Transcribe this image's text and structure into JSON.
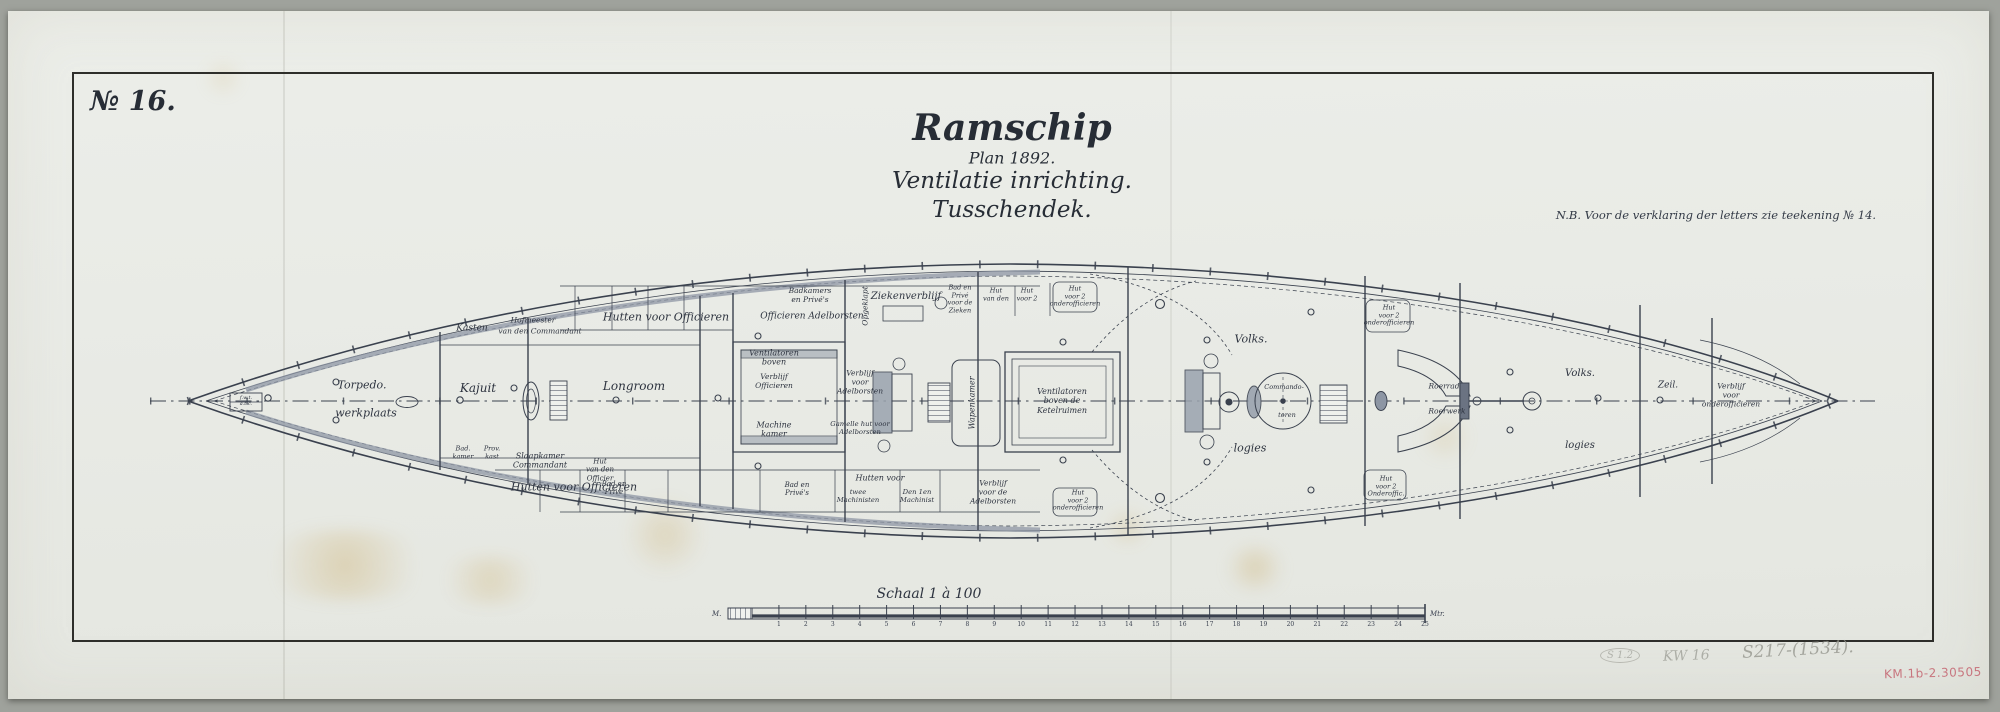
{
  "page": {
    "drawing_number": "№ 16.",
    "note": "N.B. Voor de verklaring der letters zie teekening № 14."
  },
  "title": {
    "line1": "Ramschip",
    "line2": "Plan 1892.",
    "line3": "Ventilatie inrichting.",
    "line4": "Tusschendek."
  },
  "scale_bar": {
    "caption": "Schaal 1 à 100",
    "unit_left": "M.",
    "unit_right": "Mtr.",
    "tick_numbers": [
      1,
      2,
      3,
      4,
      5,
      6,
      7,
      8,
      9,
      10,
      11,
      12,
      13,
      14,
      15,
      16,
      17,
      18,
      19,
      20,
      21,
      22,
      23,
      24,
      25
    ]
  },
  "annotations": {
    "pencil_circled": "S 1.2",
    "pencil_mark_1": "KW 16",
    "pencil_mark_2": "S217-(1534).",
    "ink_stamp": "KM.1b-2.30505",
    "ink_stamp_color": "#c4636f"
  },
  "ship_labels": [
    {
      "t": "Torpedo.",
      "x": 362,
      "y": 386,
      "s": 11
    },
    {
      "t": "werkplaats",
      "x": 366,
      "y": 414,
      "s": 11
    },
    {
      "t": "f.w.t.\na.t.c.",
      "x": 246,
      "y": 402,
      "s": 5
    },
    {
      "t": "Kasten",
      "x": 472,
      "y": 329,
      "s": 9
    },
    {
      "t": "Hofmeester",
      "x": 533,
      "y": 321,
      "s": 7.5
    },
    {
      "t": "van den Commandant",
      "x": 540,
      "y": 332,
      "s": 7.5
    },
    {
      "t": "Kajuit",
      "x": 478,
      "y": 388,
      "s": 12
    },
    {
      "t": "Bad.\nkamer",
      "x": 463,
      "y": 453,
      "s": 6.5
    },
    {
      "t": "Prov.\nkast",
      "x": 492,
      "y": 453,
      "s": 6.5
    },
    {
      "t": "Slaapkamer\nCommandant",
      "x": 540,
      "y": 461,
      "s": 8
    },
    {
      "t": "Hut\nvan den\nOfficier",
      "x": 600,
      "y": 470,
      "s": 7
    },
    {
      "t": "Longroom",
      "x": 634,
      "y": 386,
      "s": 12
    },
    {
      "t": "Hutten voor Officieren",
      "x": 666,
      "y": 318,
      "s": 11
    },
    {
      "t": "Hutten voor Officieren",
      "x": 574,
      "y": 488,
      "s": 11
    },
    {
      "t": "Badkamers\nen Privé's",
      "x": 810,
      "y": 296,
      "s": 7.5
    },
    {
      "t": "Officieren  Adelborsten",
      "x": 812,
      "y": 317,
      "s": 9
    },
    {
      "t": "Opgeklapt",
      "x": 866,
      "y": 306,
      "s": 7.5,
      "r": -90
    },
    {
      "t": "Ziekenverblijf",
      "x": 906,
      "y": 297,
      "s": 10
    },
    {
      "t": "Bad en\nPrivé\nvoor de\nZieken",
      "x": 960,
      "y": 300,
      "s": 6.5
    },
    {
      "t": "Hut\nvan den",
      "x": 996,
      "y": 295,
      "s": 6.5
    },
    {
      "t": "Hut\nvoor 2",
      "x": 1027,
      "y": 295,
      "s": 6.5
    },
    {
      "t": "Hut\nvoor 2\nonderofficieren",
      "x": 1075,
      "y": 297,
      "s": 6.5
    },
    {
      "t": "Ventilatoren\nboven",
      "x": 774,
      "y": 358,
      "s": 8
    },
    {
      "t": "Verblijf\nOfficieren",
      "x": 774,
      "y": 382,
      "s": 7.5
    },
    {
      "t": "Machine\nkamer",
      "x": 774,
      "y": 430,
      "s": 8
    },
    {
      "t": "Verblijf\nvoor\nAdelborsten",
      "x": 860,
      "y": 383,
      "s": 7.5
    },
    {
      "t": "Gamelle hut voor\nAdelborsten",
      "x": 860,
      "y": 428,
      "s": 6.8
    },
    {
      "t": "Bad en\nPrivé",
      "x": 614,
      "y": 488,
      "s": 7
    },
    {
      "t": "Bad en\nPrivé's",
      "x": 797,
      "y": 489,
      "s": 7
    },
    {
      "t": "Hutten voor",
      "x": 880,
      "y": 478,
      "s": 8
    },
    {
      "t": "twee\nMachinisten",
      "x": 858,
      "y": 496,
      "s": 6.8
    },
    {
      "t": "Den 1en\nMachinist",
      "x": 917,
      "y": 496,
      "s": 6.8
    },
    {
      "t": "Verblijf\nvoor de\nAdelborsten",
      "x": 993,
      "y": 493,
      "s": 7.5
    },
    {
      "t": "Wapenkamer",
      "x": 972,
      "y": 403,
      "s": 8,
      "r": -90
    },
    {
      "t": "Ventilatoren\nboven de\nKetelruimen",
      "x": 1062,
      "y": 401,
      "s": 8
    },
    {
      "t": "Volks.",
      "x": 1251,
      "y": 340,
      "s": 11
    },
    {
      "t": "logies",
      "x": 1250,
      "y": 449,
      "s": 11
    },
    {
      "t": "Commando-",
      "x": 1284,
      "y": 388,
      "s": 6.5
    },
    {
      "t": "toren",
      "x": 1287,
      "y": 416,
      "s": 6.5
    },
    {
      "t": "Hut\nvoor 2\nonderofficieren",
      "x": 1389,
      "y": 316,
      "s": 6.5
    },
    {
      "t": "Hut\nvoor 2\nOnderoffic.",
      "x": 1386,
      "y": 487,
      "s": 6.5
    },
    {
      "t": "Hut\nvoor 2\nonderofficieren",
      "x": 1078,
      "y": 501,
      "s": 6.5
    },
    {
      "t": "Roerrad",
      "x": 1444,
      "y": 387,
      "s": 7.5
    },
    {
      "t": "Roerwerk",
      "x": 1447,
      "y": 412,
      "s": 7.5
    },
    {
      "t": "Volks.",
      "x": 1580,
      "y": 374,
      "s": 10
    },
    {
      "t": "logies",
      "x": 1580,
      "y": 446,
      "s": 10
    },
    {
      "t": "Zeil.",
      "x": 1668,
      "y": 386,
      "s": 9
    },
    {
      "t": "Verblijf\nvoor\nonderofficieren",
      "x": 1731,
      "y": 396,
      "s": 7.5
    }
  ]
}
